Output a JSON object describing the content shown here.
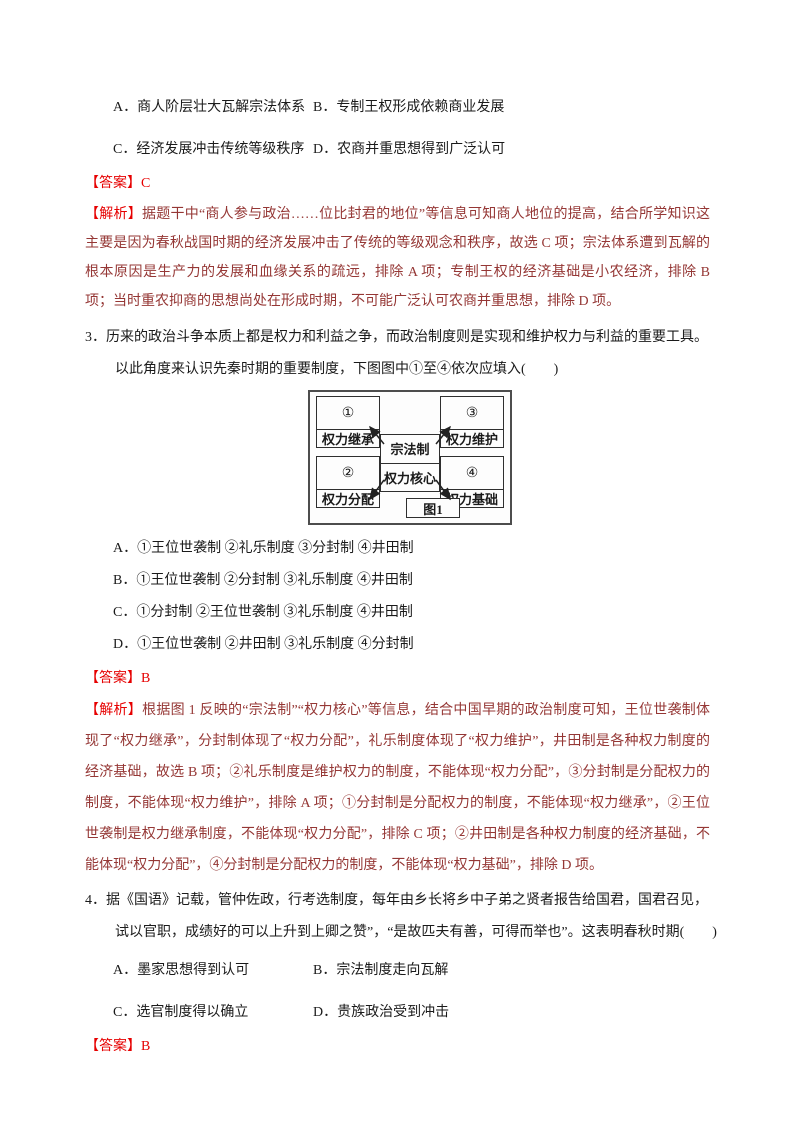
{
  "colors": {
    "answer_red": "#e60000",
    "analysis_dark_red": "#953735",
    "body_text": "#1a1a1a",
    "page_background": "#ffffff"
  },
  "question2": {
    "options": [
      "A．商人阶层壮大瓦解宗法体系",
      "B．专制王权形成依赖商业发展",
      "C．经济发展冲击传统等级秩序",
      "D．农商并重思想得到广泛认可"
    ],
    "answer_label": "【答案】",
    "answer": "C",
    "analysis_label": "【解析】",
    "analysis_text": "据题干中“商人参与政治……位比封君的地位”等信息可知商人地位的提高，结合所学知识这主要是因为春秋战国时期的经济发展冲击了传统的等级观念和秩序，故选 C 项；宗法体系遭到瓦解的根本原因是生产力的发展和血缘关系的疏远，排除 A 项；专制王权的经济基础是小农经济，排除 B 项；当时重农抑商的思想尚处在形成时期，不可能广泛认可农商并重思想，排除 D 项。"
  },
  "question3": {
    "number": "3．",
    "stem_lines": [
      "历来的政治斗争本质上都是权力和利益之争，而政治制度则是实现和维护权力与利益的重要工具。",
      "以此角度来认识先秦时期的重要制度，下图图中①至④依次应填入(　　)"
    ],
    "diagram": {
      "caption": "图1",
      "center_top": "宗法制",
      "center_bottom": "权力核心",
      "corners": [
        {
          "num": "①",
          "label": "权力继承"
        },
        {
          "num": "②",
          "label": "权力分配"
        },
        {
          "num": "③",
          "label": "权力维护"
        },
        {
          "num": "④",
          "label": "权力基础"
        }
      ]
    },
    "options": [
      "A．①王位世袭制 ②礼乐制度 ③分封制 ④井田制",
      "B．①王位世袭制 ②分封制 ③礼乐制度 ④井田制",
      "C．①分封制 ②王位世袭制 ③礼乐制度 ④井田制",
      "D．①王位世袭制 ②井田制 ③礼乐制度 ④分封制"
    ],
    "answer_label": "【答案】",
    "answer": "B",
    "analysis_label": "【解析】",
    "analysis_text": "根据图 1 反映的“宗法制”“权力核心”等信息，结合中国早期的政治制度可知，王位世袭制体现了“权力继承”，分封制体现了“权力分配”，礼乐制度体现了“权力维护”，井田制是各种权力制度的经济基础，故选 B 项；②礼乐制度是维护权力的制度，不能体现“权力分配”，③分封制是分配权力的制度，不能体现“权力维护”，排除 A 项；①分封制是分配权力的制度，不能体现“权力继承”，②王位世袭制是权力继承制度，不能体现“权力分配”，排除 C 项；②井田制是各种权力制度的经济基础，不能体现“权力分配”，④分封制是分配权力的制度，不能体现“权力基础”，排除 D 项。"
  },
  "question4": {
    "number": "4．",
    "stem_lines": [
      "据《国语》记载，管仲佐政，行考选制度，每年由乡长将乡中子弟之贤者报告给国君，国君召见，",
      "试以官职，成绩好的可以上升到上卿之赞”，“是故匹夫有善，可得而举也”。这表明春秋时期(　　)"
    ],
    "options": [
      "A．墨家思想得到认可",
      "B．宗法制度走向瓦解",
      "C．选官制度得以确立",
      "D．贵族政治受到冲击"
    ],
    "answer_label": "【答案】",
    "answer": "B"
  }
}
